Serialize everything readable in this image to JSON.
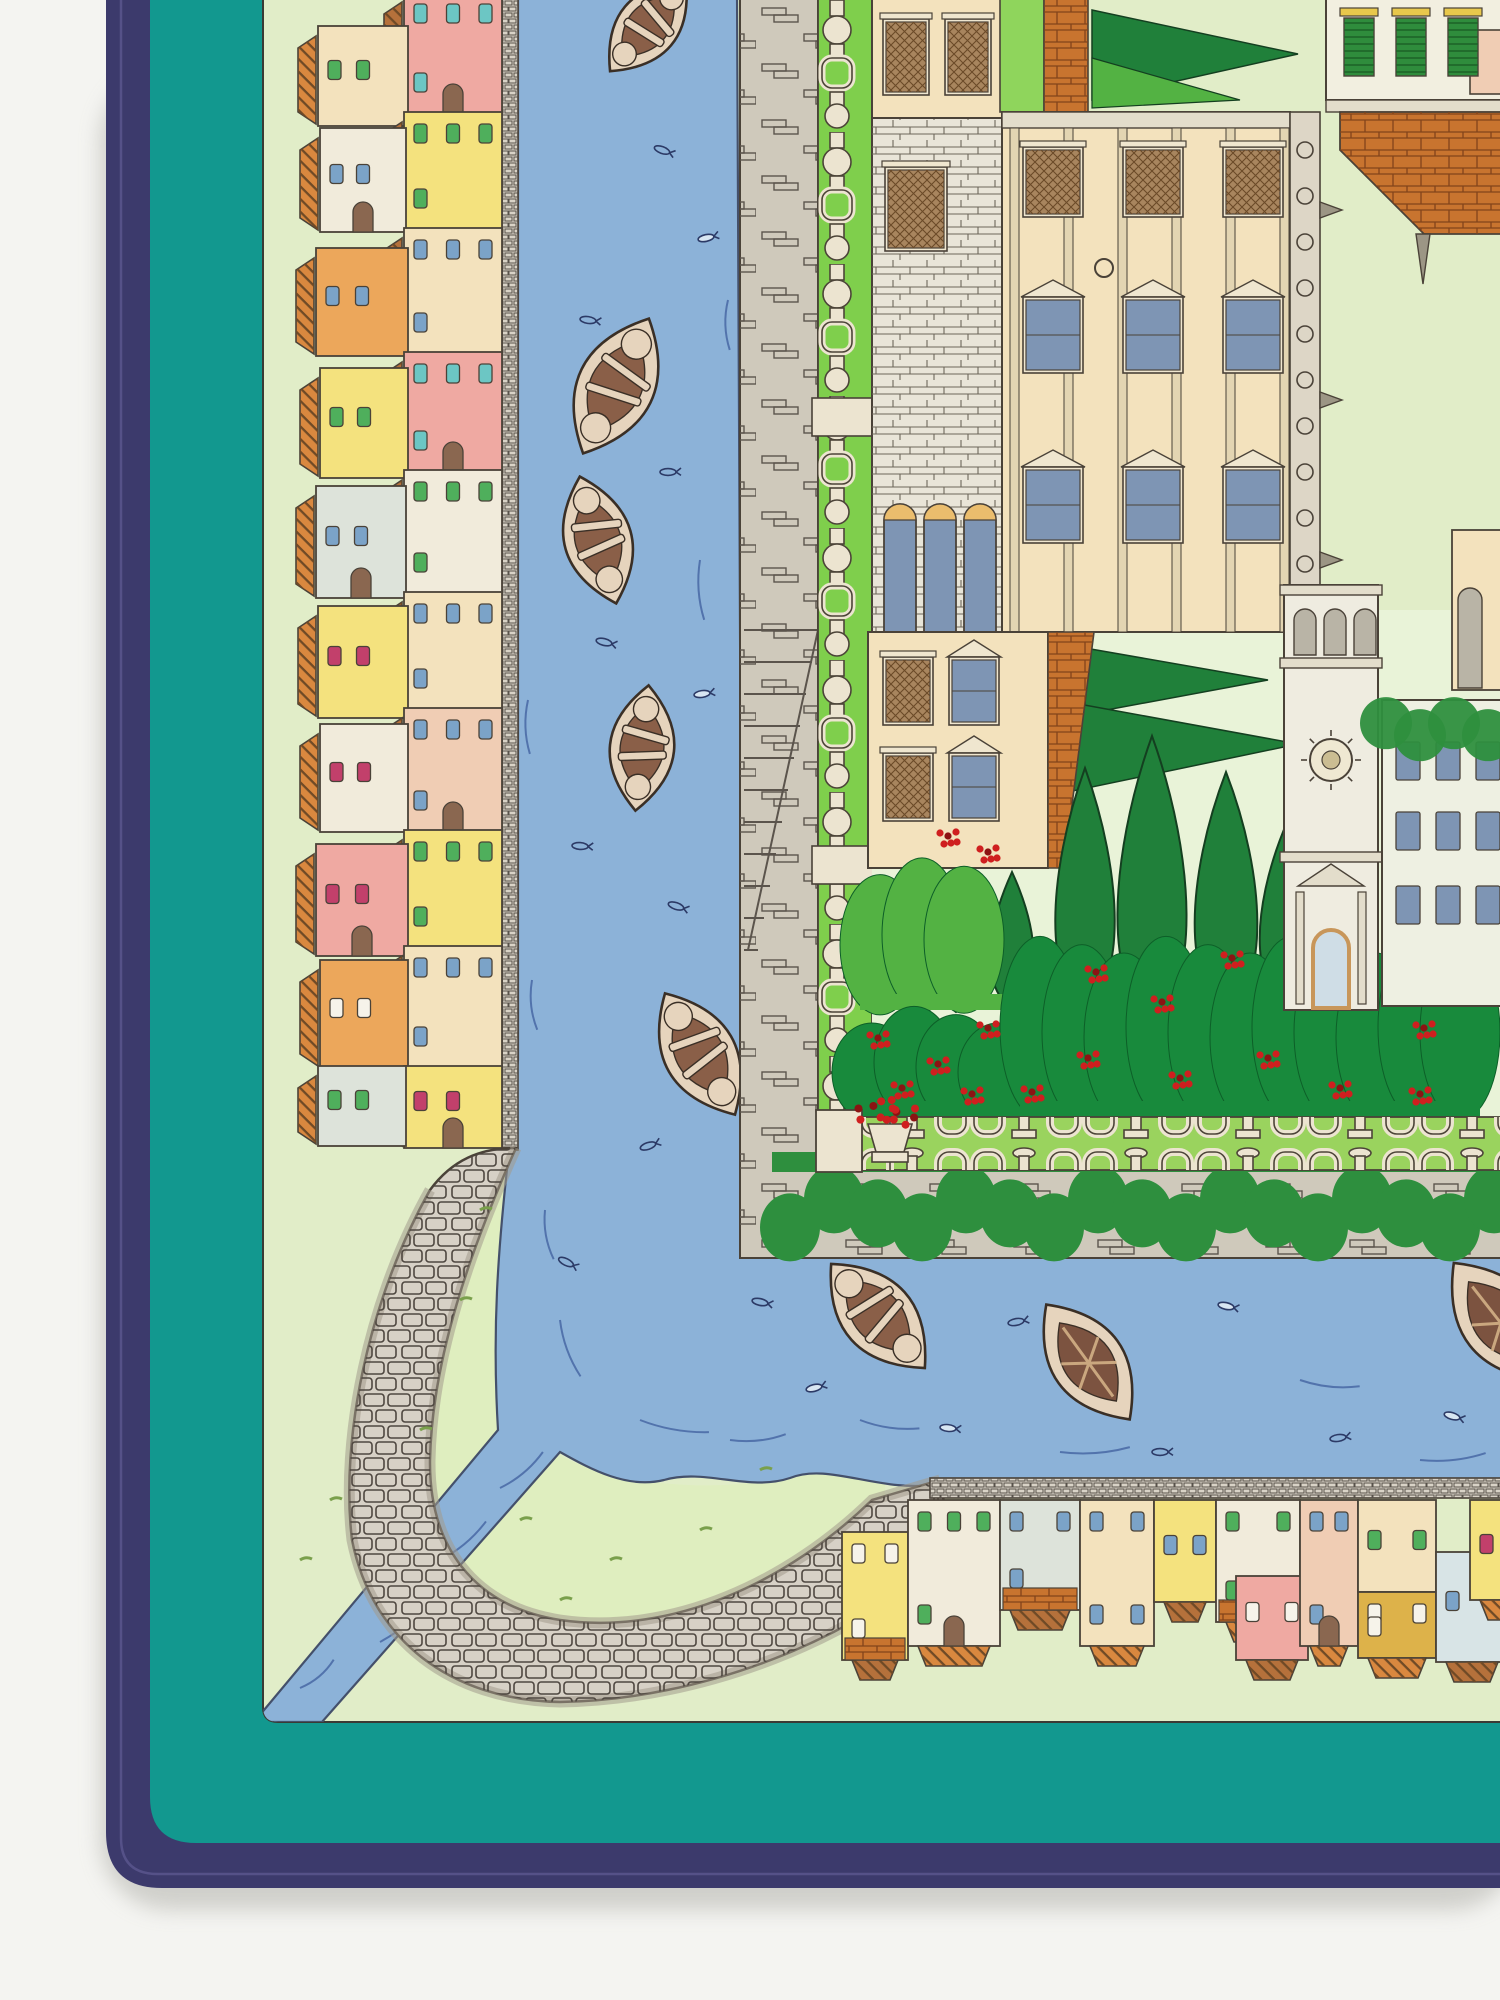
{
  "colors": {
    "page": "#f4f4f1",
    "shadow": "#c9c9c4",
    "navy": "#3c3a6c",
    "hem": "#5b5890",
    "teal": "#12988f",
    "field": "#e1edc8",
    "lawn": "#e9f3d8",
    "bank": "#dfeebf",
    "water": "#8cb2d8",
    "waterline": "#3f5d9e",
    "wateredge": "#44506b",
    "quay": "#d9d3c7",
    "wall": "#cfc9bb",
    "stoneline": "#5b544c",
    "road": "#d7d1c6",
    "roadedge": "#a29a8d",
    "hedge": "#7fcf4c",
    "hedgelight": "#8fd55c",
    "trellis": "#ece4d0",
    "bal": "#9ad35e",
    "ivy": "#2e8f3e",
    "bushmid": "#53b243",
    "bushdark": "#188a3c",
    "cypress": "#20803a",
    "red": "#cf1f1f",
    "redDark": "#8c1313",
    "cream": "#f3e2bd",
    "stonebase": "#e9e5d8",
    "brick": "#c8742f",
    "glass": "#7e95b4",
    "lunette": "#eabd6d",
    "shutter": "#a8855e",
    "tower": "#efece0",
    "cornice": "#e3ddcb",
    "arch": "#b9b4a6",
    "frame": "#efe6cf",
    "pink": "#efa9a2",
    "white": "#f1ebdb",
    "yellow": "#f4e27e",
    "orange": "#eca75b",
    "blueGray": "#dde3da",
    "peach": "#f0cdb4",
    "mustard": "#ddb24a",
    "lightBlue": "#d8e4e6",
    "winBlue": "#7ba3c8",
    "winGreen": "#4faf5c",
    "winTeal": "#6cc6c4",
    "winRed": "#c2406b",
    "winWhite": "#f6f3ea",
    "outline": "#4a4238",
    "roofA": "#b5713b",
    "roofB": "#d9883f",
    "boathull": "#e6d4bd",
    "boatin": "#8a5f48",
    "bargein": "#7c5340",
    "boatline": "#3a2f26",
    "doorbrown": "#8a6750",
    "greenshutter": "#2f8c3c",
    "lintel": "#e8c84c"
  },
  "left_village": {
    "houses": [
      {
        "x": 404,
        "y": -8,
        "w": 98,
        "h": 122,
        "c": "pink",
        "wc": "winTeal",
        "win": 4,
        "door": true
      },
      {
        "x": 318,
        "y": 26,
        "w": 90,
        "h": 100,
        "c": "cream",
        "wc": "winGreen",
        "win": 2
      },
      {
        "x": 404,
        "y": 112,
        "w": 98,
        "h": 118,
        "c": "yellow",
        "wc": "winGreen",
        "win": 4
      },
      {
        "x": 320,
        "y": 128,
        "w": 86,
        "h": 104,
        "c": "white",
        "wc": "winBlue",
        "win": 2,
        "door": true
      },
      {
        "x": 404,
        "y": 228,
        "w": 98,
        "h": 126,
        "c": "cream",
        "wc": "winBlue",
        "win": 4
      },
      {
        "x": 316,
        "y": 248,
        "w": 92,
        "h": 108,
        "c": "orange",
        "wc": "winBlue",
        "win": 2
      },
      {
        "x": 404,
        "y": 352,
        "w": 98,
        "h": 120,
        "c": "pink",
        "wc": "winTeal",
        "win": 4,
        "door": true
      },
      {
        "x": 320,
        "y": 368,
        "w": 88,
        "h": 110,
        "c": "yellow",
        "wc": "winGreen",
        "win": 2
      },
      {
        "x": 404,
        "y": 470,
        "w": 98,
        "h": 124,
        "c": "white",
        "wc": "winGreen",
        "win": 4
      },
      {
        "x": 316,
        "y": 486,
        "w": 90,
        "h": 112,
        "c": "blueGray",
        "wc": "winBlue",
        "win": 2,
        "door": true
      },
      {
        "x": 404,
        "y": 592,
        "w": 98,
        "h": 118,
        "c": "cream",
        "wc": "winBlue",
        "win": 4
      },
      {
        "x": 318,
        "y": 606,
        "w": 90,
        "h": 112,
        "c": "yellow",
        "wc": "winRed",
        "win": 2
      },
      {
        "x": 404,
        "y": 708,
        "w": 98,
        "h": 124,
        "c": "peach",
        "wc": "winBlue",
        "win": 4,
        "door": true
      },
      {
        "x": 320,
        "y": 724,
        "w": 88,
        "h": 108,
        "c": "white",
        "wc": "winRed",
        "win": 2
      },
      {
        "x": 404,
        "y": 830,
        "w": 98,
        "h": 118,
        "c": "yellow",
        "wc": "winGreen",
        "win": 4
      },
      {
        "x": 316,
        "y": 844,
        "w": 92,
        "h": 112,
        "c": "pink",
        "wc": "winRed",
        "win": 2,
        "door": true
      },
      {
        "x": 404,
        "y": 946,
        "w": 98,
        "h": 122,
        "c": "cream",
        "wc": "winBlue",
        "win": 4
      },
      {
        "x": 320,
        "y": 960,
        "w": 88,
        "h": 108,
        "c": "orange",
        "wc": "winWhite",
        "win": 2
      },
      {
        "x": 404,
        "y": 1066,
        "w": 98,
        "h": 82,
        "c": "yellow",
        "wc": "winRed",
        "win": 2,
        "door": true
      },
      {
        "x": 318,
        "y": 1066,
        "w": 88,
        "h": 80,
        "c": "blueGray",
        "wc": "winGreen",
        "win": 2
      }
    ]
  },
  "bottom_village": {
    "houses": [
      {
        "x": 842,
        "y": 1532,
        "w": 66,
        "h": 128,
        "c": "yellow",
        "wc": "winWhite",
        "win": 3,
        "base": "brick"
      },
      {
        "x": 908,
        "y": 1500,
        "w": 92,
        "h": 146,
        "c": "white",
        "wc": "winGreen",
        "win": 4,
        "door": true
      },
      {
        "x": 1000,
        "y": 1500,
        "w": 80,
        "h": 110,
        "c": "blueGray",
        "wc": "winBlue",
        "win": 3,
        "base": "brick"
      },
      {
        "x": 1080,
        "y": 1500,
        "w": 74,
        "h": 146,
        "c": "cream",
        "wc": "winBlue",
        "win": 4
      },
      {
        "x": 1154,
        "y": 1500,
        "w": 62,
        "h": 102,
        "c": "yellow",
        "wc": "winBlue",
        "win": 2
      },
      {
        "x": 1216,
        "y": 1500,
        "w": 84,
        "h": 122,
        "c": "white",
        "wc": "winGreen",
        "win": 4,
        "base": "brick"
      },
      {
        "x": 1236,
        "y": 1576,
        "w": 72,
        "h": 84,
        "c": "pink",
        "wc": "winWhite",
        "win": 2
      },
      {
        "x": 1300,
        "y": 1500,
        "w": 58,
        "h": 146,
        "c": "peach",
        "wc": "winBlue",
        "win": 3,
        "door": true
      },
      {
        "x": 1358,
        "y": 1500,
        "w": 78,
        "h": 92,
        "c": "cream",
        "wc": "winGreen",
        "win": 2
      },
      {
        "x": 1358,
        "y": 1592,
        "w": 78,
        "h": 66,
        "c": "mustard",
        "wc": "winWhite",
        "win": 3
      },
      {
        "x": 1436,
        "y": 1552,
        "w": 72,
        "h": 110,
        "c": "lightBlue",
        "wc": "winBlue",
        "win": 2
      },
      {
        "x": 1470,
        "y": 1500,
        "w": 60,
        "h": 100,
        "c": "yellow",
        "wc": "winRed",
        "win": 2
      }
    ]
  },
  "boats": [
    {
      "x": 648,
      "y": 26,
      "r": 40,
      "l": 118,
      "t": "striped"
    },
    {
      "x": 616,
      "y": 386,
      "r": 26,
      "l": 150,
      "t": "striped"
    },
    {
      "x": 598,
      "y": 540,
      "r": -16,
      "l": 132,
      "t": "striped"
    },
    {
      "x": 642,
      "y": 748,
      "r": 6,
      "l": 126,
      "t": "striped"
    },
    {
      "x": 700,
      "y": 1054,
      "r": -30,
      "l": 140,
      "t": "striped"
    },
    {
      "x": 878,
      "y": 1316,
      "r": -42,
      "l": 140,
      "t": "striped"
    },
    {
      "x": 1088,
      "y": 1362,
      "r": -36,
      "l": 142,
      "t": "barge"
    },
    {
      "x": 1500,
      "y": 1322,
      "r": -38,
      "l": 150,
      "t": "barge"
    }
  ],
  "fish": [
    {
      "x": 662,
      "y": 150,
      "r": 20
    },
    {
      "x": 706,
      "y": 238,
      "r": -12,
      "f": 1
    },
    {
      "x": 588,
      "y": 320,
      "r": 8
    },
    {
      "x": 668,
      "y": 472,
      "r": 0
    },
    {
      "x": 604,
      "y": 642,
      "r": 14
    },
    {
      "x": 702,
      "y": 694,
      "r": -8,
      "f": 1
    },
    {
      "x": 580,
      "y": 846,
      "r": 4
    },
    {
      "x": 676,
      "y": 906,
      "r": 18
    },
    {
      "x": 648,
      "y": 1146,
      "r": -18
    },
    {
      "x": 566,
      "y": 1262,
      "r": 26
    },
    {
      "x": 814,
      "y": 1388,
      "r": -14,
      "f": 1
    },
    {
      "x": 948,
      "y": 1428,
      "r": 6,
      "f": 1
    },
    {
      "x": 1016,
      "y": 1322,
      "r": -10
    },
    {
      "x": 1226,
      "y": 1306,
      "r": 12,
      "f": 1
    },
    {
      "x": 1338,
      "y": 1438,
      "r": -8
    },
    {
      "x": 1452,
      "y": 1416,
      "r": 16,
      "f": 1
    },
    {
      "x": 1160,
      "y": 1452,
      "r": 0
    },
    {
      "x": 760,
      "y": 1302,
      "r": 12
    }
  ],
  "currents": [
    {
      "x": 380,
      "y": 1642,
      "r": -40,
      "l": 70
    },
    {
      "x": 440,
      "y": 1560,
      "r": -40,
      "l": 60
    },
    {
      "x": 500,
      "y": 1488,
      "r": -40,
      "l": 56
    },
    {
      "x": 300,
      "y": 1688,
      "r": -40,
      "l": 44
    },
    {
      "x": 560,
      "y": 1320,
      "r": 70,
      "l": 60
    },
    {
      "x": 545,
      "y": 1210,
      "r": 80,
      "l": 50
    },
    {
      "x": 640,
      "y": 1420,
      "r": 10,
      "l": 70
    },
    {
      "x": 730,
      "y": 1440,
      "r": -6,
      "l": 56
    },
    {
      "x": 860,
      "y": 1420,
      "r": 8,
      "l": 60
    },
    {
      "x": 1060,
      "y": 1452,
      "r": -4,
      "l": 70
    },
    {
      "x": 1300,
      "y": 1380,
      "r": 6,
      "l": 60
    },
    {
      "x": 1420,
      "y": 1460,
      "r": -6,
      "l": 66
    },
    {
      "x": 700,
      "y": 560,
      "r": 86,
      "l": 60
    },
    {
      "x": 728,
      "y": 300,
      "r": 88,
      "l": 50
    },
    {
      "x": 528,
      "y": 700,
      "r": 88,
      "l": 54
    },
    {
      "x": 532,
      "y": 980,
      "r": 84,
      "l": 50
    }
  ],
  "flower_clusters": [
    {
      "x": 1096,
      "y": 972
    },
    {
      "x": 1162,
      "y": 1002
    },
    {
      "x": 1232,
      "y": 958
    },
    {
      "x": 1302,
      "y": 998
    },
    {
      "x": 1364,
      "y": 972
    },
    {
      "x": 1424,
      "y": 1028
    },
    {
      "x": 1088,
      "y": 1058
    },
    {
      "x": 1180,
      "y": 1078
    },
    {
      "x": 1268,
      "y": 1058
    },
    {
      "x": 1340,
      "y": 1088
    },
    {
      "x": 1420,
      "y": 1094
    },
    {
      "x": 1452,
      "y": 988
    },
    {
      "x": 878,
      "y": 1038
    },
    {
      "x": 938,
      "y": 1064
    },
    {
      "x": 988,
      "y": 1028
    },
    {
      "x": 902,
      "y": 1088
    },
    {
      "x": 972,
      "y": 1094
    },
    {
      "x": 1032,
      "y": 1092
    },
    {
      "x": 948,
      "y": 836
    },
    {
      "x": 988,
      "y": 852
    }
  ],
  "cypresses": [
    {
      "x": 1085,
      "tip": 768,
      "base": 1004,
      "w": 74
    },
    {
      "x": 1152,
      "tip": 736,
      "base": 1012,
      "w": 86
    },
    {
      "x": 1226,
      "tip": 772,
      "base": 1006,
      "w": 78
    },
    {
      "x": 1283,
      "tip": 832,
      "base": 1000,
      "w": 58
    },
    {
      "x": 1012,
      "tip": 872,
      "base": 1008,
      "w": 54
    },
    {
      "x": 956,
      "tip": 906,
      "base": 1012,
      "w": 46
    }
  ]
}
